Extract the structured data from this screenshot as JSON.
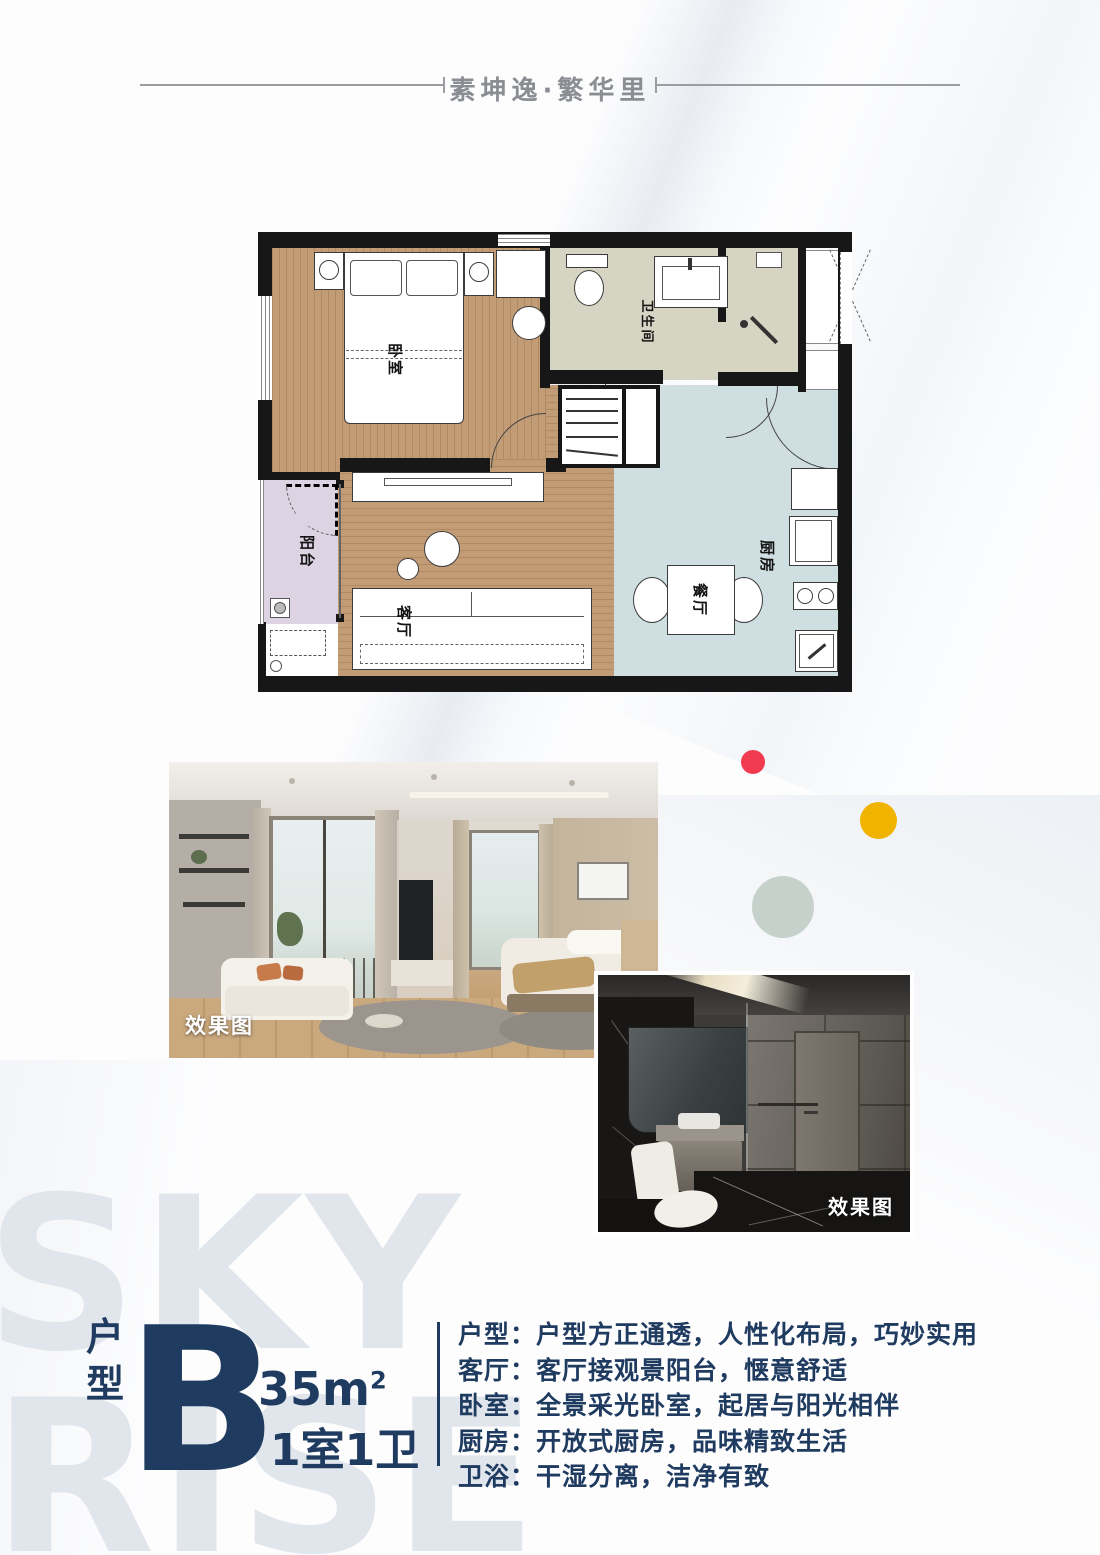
{
  "header": {
    "project_name": "素坤逸·繁华里"
  },
  "floor_plan": {
    "rooms": [
      {
        "name": "bedroom",
        "label": "卧室"
      },
      {
        "name": "bathroom",
        "label": "卫生间"
      },
      {
        "name": "balcony",
        "label": "阳台"
      },
      {
        "name": "living-room",
        "label": "客厅"
      },
      {
        "name": "dining",
        "label": "餐厅"
      },
      {
        "name": "kitchen",
        "label": "厨房"
      }
    ]
  },
  "photos": [
    {
      "label": "效果图"
    },
    {
      "label": "效果图"
    }
  ],
  "watermark": {
    "line1": "SKY",
    "line2": "RISE"
  },
  "unit_info": {
    "type_label": "户型",
    "type_letter": "B",
    "area_value": "35m",
    "area_sup": "2",
    "rooms_label": "1室1卫"
  },
  "features": [
    {
      "line": "户型：户型方正通透，人性化布局，巧妙实用"
    },
    {
      "line": "客厅：客厅接观景阳台，惬意舒适"
    },
    {
      "line": "卧室：全景采光卧室，起居与阳光相伴"
    },
    {
      "line": "厨房：开放式厨房，品味精致生活"
    },
    {
      "line": "卫浴：干湿分离，洁净有致"
    }
  ],
  "colors": {
    "accent_navy": "#1f3b60",
    "dot_red": "#f23a50",
    "dot_yellow": "#f0b300",
    "dot_celadon": "#c6d1cc",
    "floor_wood": "#c19b75",
    "floor_kitchen": "#cfdee0",
    "floor_bathroom": "#d6d5c4",
    "floor_balcony": "#ded3e3",
    "watermark_gray": "#e1e5ec"
  }
}
